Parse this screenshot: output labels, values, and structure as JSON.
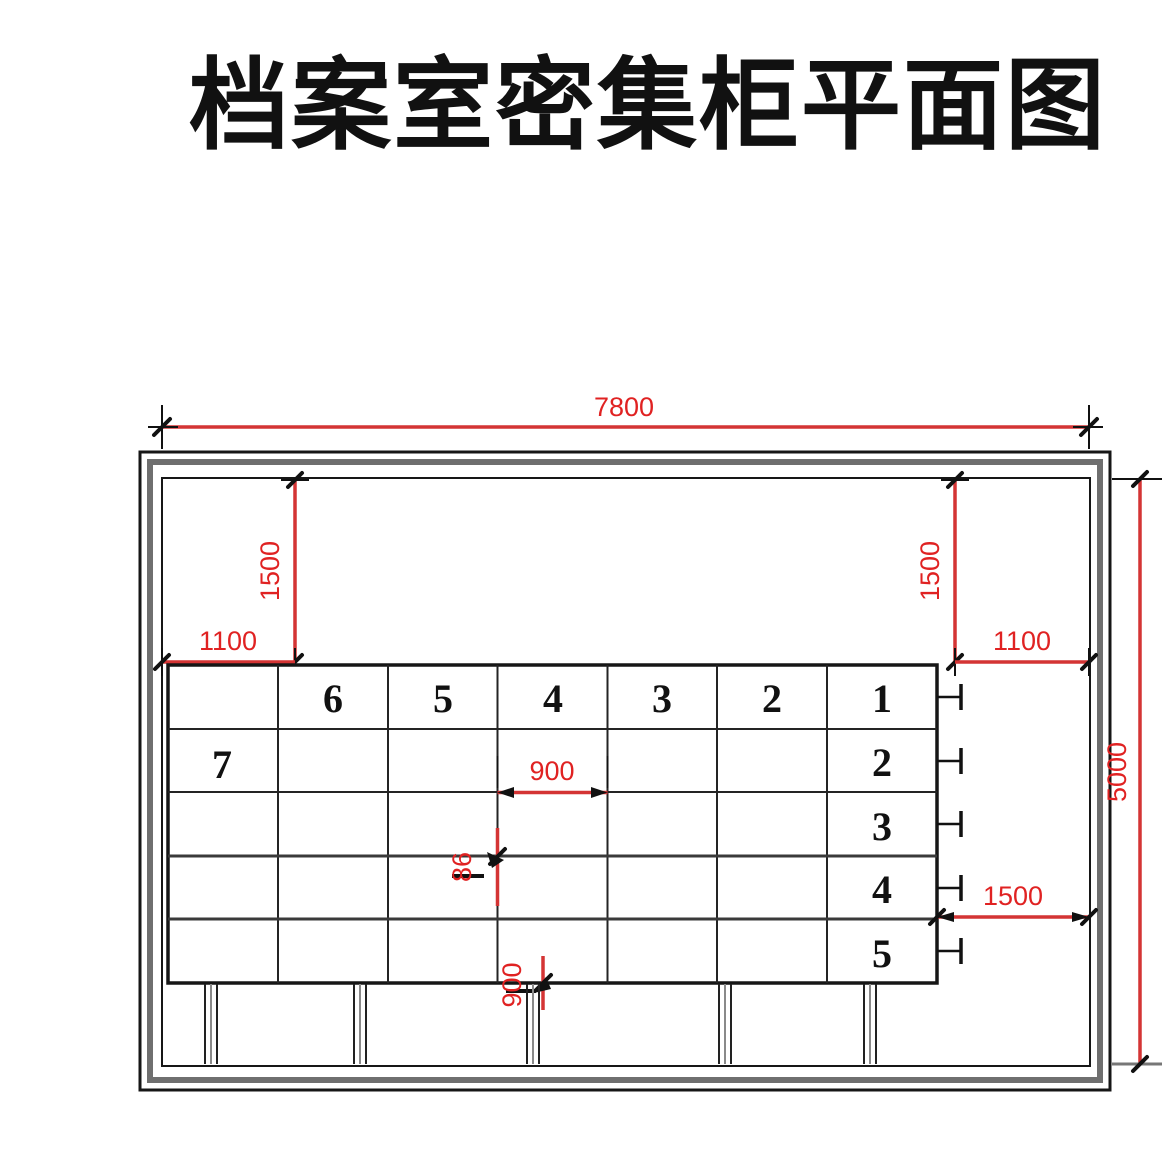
{
  "title": "档案室密集柜平面图",
  "colors": {
    "dimension_red": "#d43434",
    "label_red": "#e02222",
    "line_black": "#161616",
    "wall_gray": "#6f6f6f"
  },
  "dimensions": {
    "room_width": "7800",
    "room_depth": "5000",
    "front_aisle_left": "1500",
    "front_aisle_right": "1500",
    "side_offset_left": "1100",
    "side_offset_right": "1100",
    "section_width": "900",
    "track_gap": "86",
    "rail_extension": "900",
    "right_aisle": "1500"
  },
  "cabinet_numbers": {
    "top_row": [
      "6",
      "5",
      "4",
      "3",
      "2",
      "1"
    ],
    "right_column_below": [
      "2",
      "3",
      "4",
      "5"
    ],
    "left_block": "7"
  }
}
